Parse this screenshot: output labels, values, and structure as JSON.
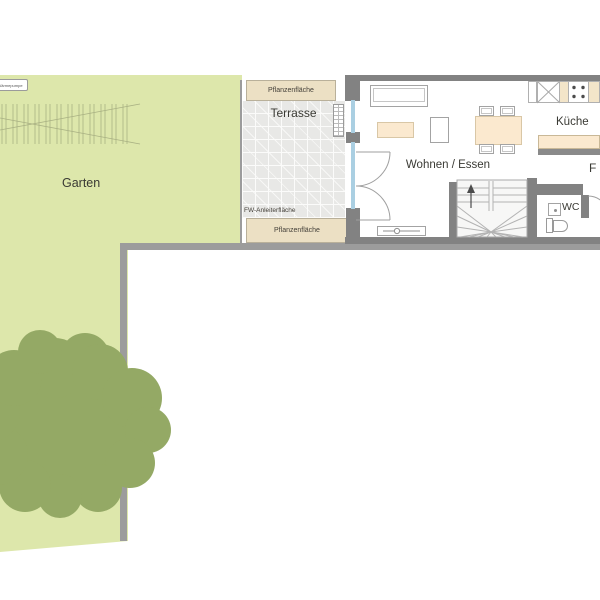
{
  "labels": {
    "garden": "Garten",
    "terrace": "Terrasse",
    "living_dining": "Wohnen / Essen",
    "kitchen": "Küche",
    "wc": "WC",
    "hall_partial": "F",
    "plant_bed": "Pflanzenfläche",
    "fw_ladder_area": "FW-Anleiterfläche",
    "heat_pump": "Wärmepumpe"
  },
  "colors": {
    "garden": "#dde7ab",
    "tree": "#94a965",
    "plant_bed": "#ece0c4",
    "furniture_beige": "#fbe9cf",
    "wall_gray": "#828282",
    "fence_gray": "#9c9c9c",
    "terrace_tile": "#e8e8e6",
    "glazing_blue": "#aacfe2"
  }
}
